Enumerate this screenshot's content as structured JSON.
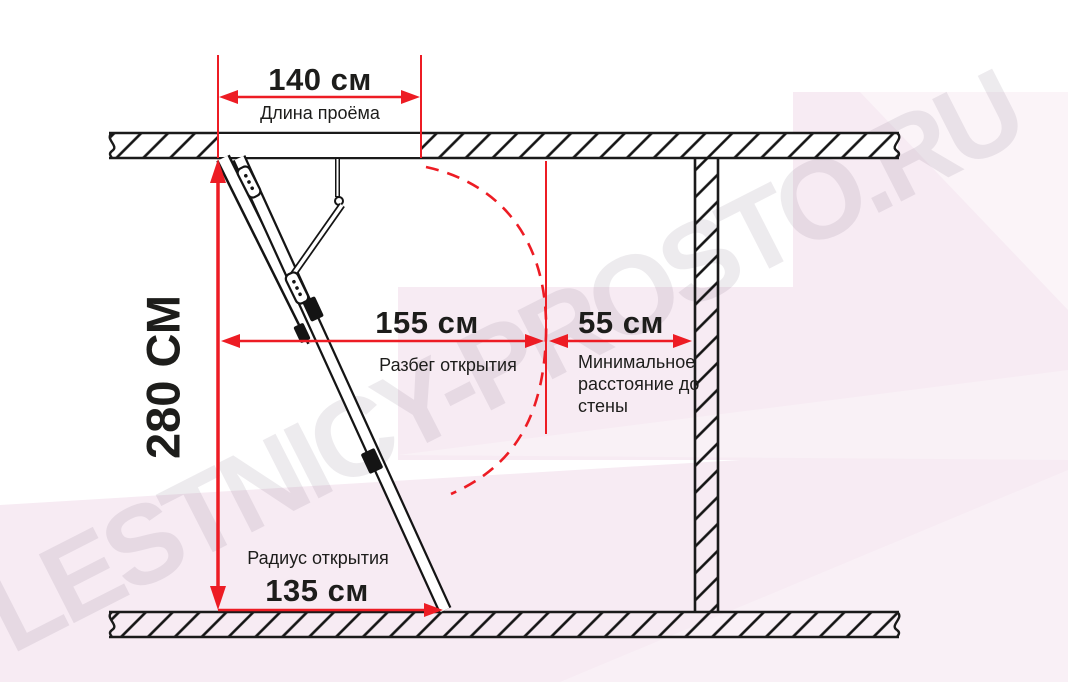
{
  "watermark": {
    "text": "LESTNICY-PROSTO.RU"
  },
  "colors": {
    "dimension_red": "#ed1c24",
    "line_black": "#1a1a1a",
    "background_pink": "#f7ebf3",
    "watermark_gray": "rgba(118,102,120,0.13)"
  },
  "dimensions": {
    "opening_length": {
      "value": "140 см",
      "label": "Длина проёма"
    },
    "ceiling_height": {
      "value": "280 СМ"
    },
    "opening_span": {
      "value": "155 см",
      "label": "Разбег открытия"
    },
    "wall_distance": {
      "value": "55 см",
      "label": "Минимальное расстояние до стены"
    },
    "opening_radius": {
      "value": "135 см",
      "label": "Радиус открытия"
    }
  }
}
